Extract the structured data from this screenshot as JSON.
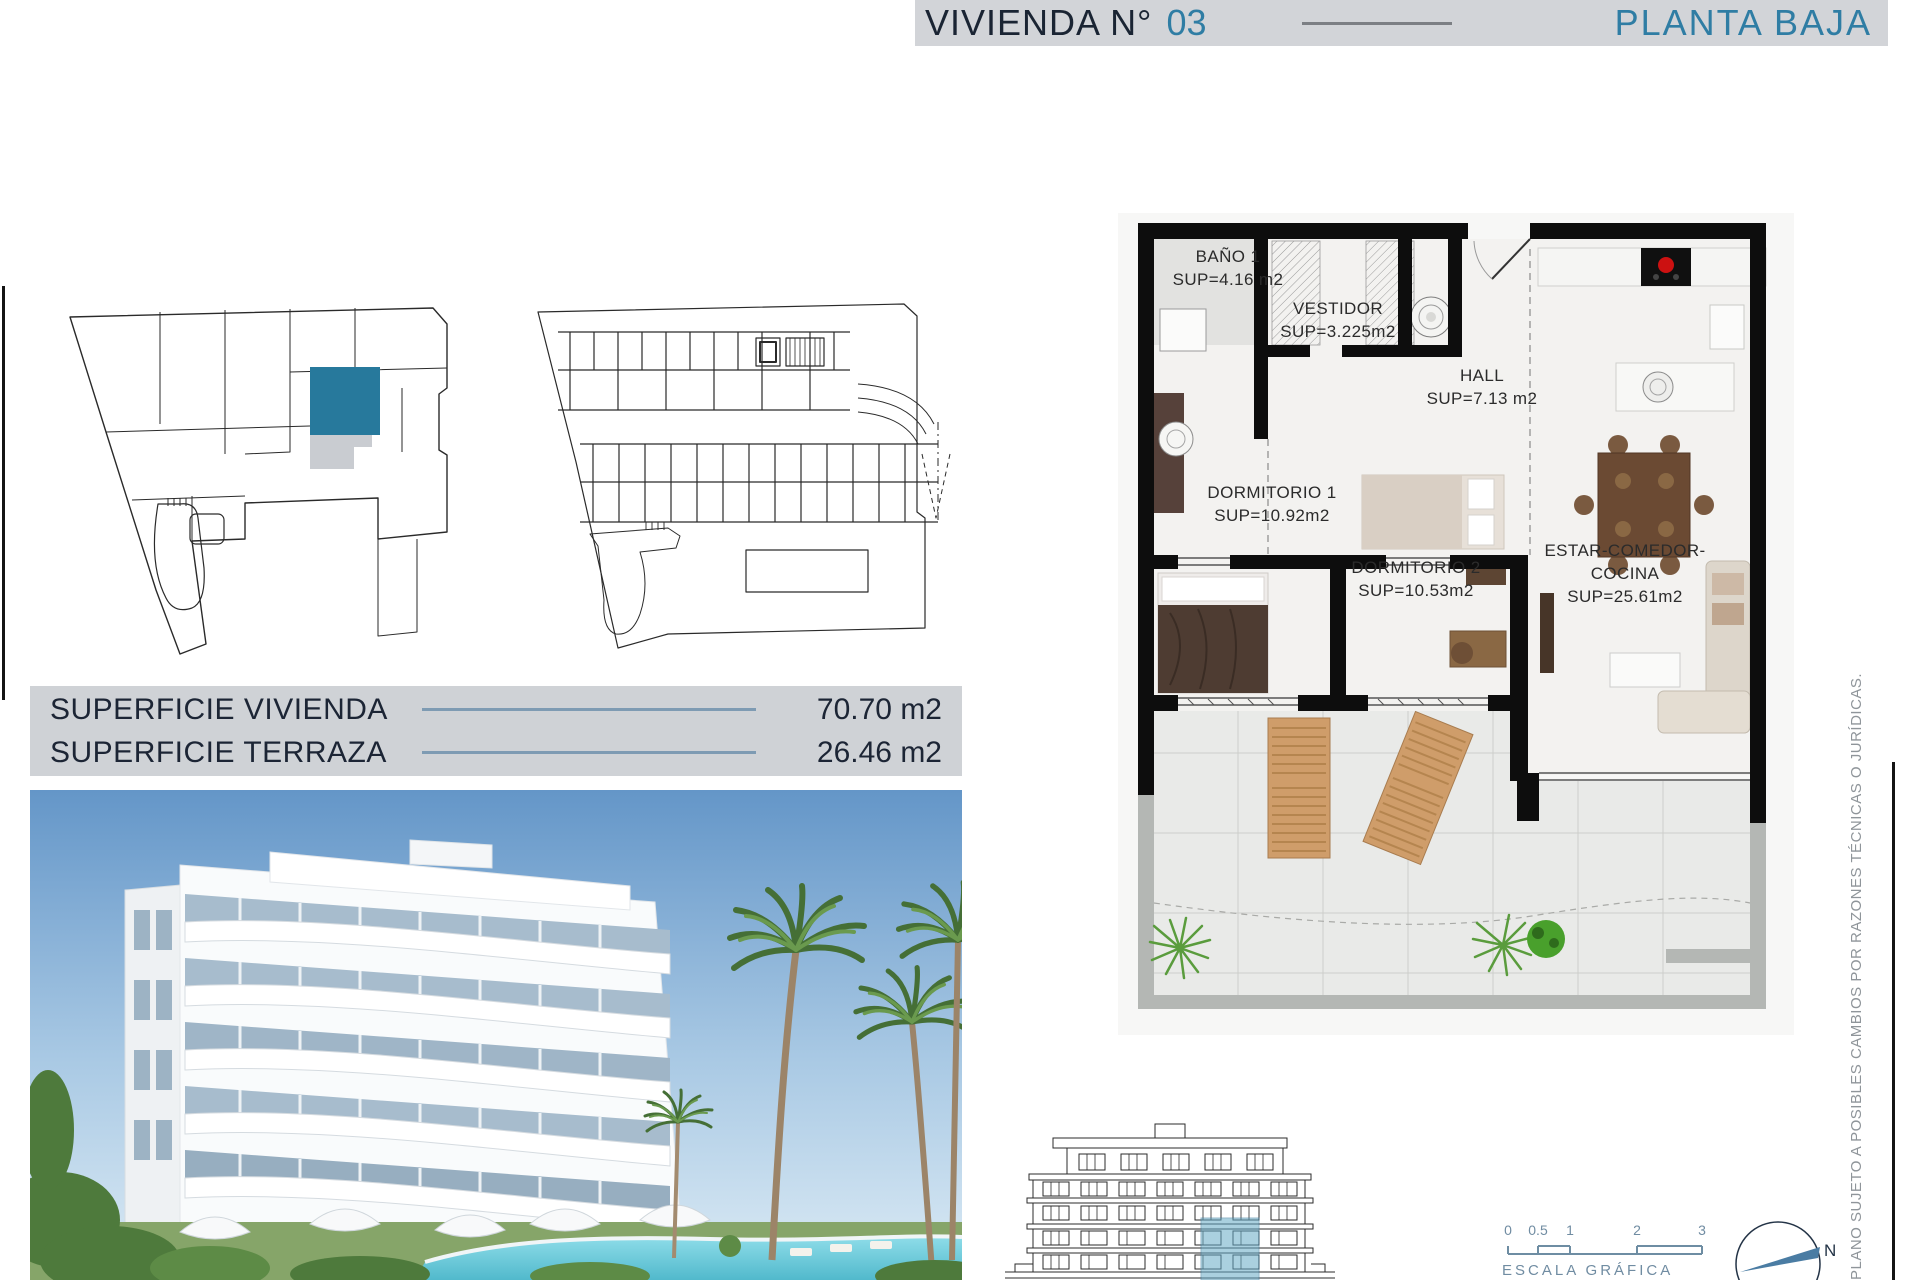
{
  "header": {
    "title_prefix": "VIVIENDA N°",
    "unit_number": "03",
    "plan_name": "PLANTA BAJA"
  },
  "surfaces": {
    "rows": [
      {
        "label": "SUPERFICIE VIVIENDA",
        "value": "70.70 m2"
      },
      {
        "label": "SUPERFICIE TERRAZA",
        "value": "26.46 m2"
      }
    ]
  },
  "floor_plan": {
    "rooms": [
      {
        "name": "BAÑO 1",
        "sup": "SUP=4.16 m2"
      },
      {
        "name": "VESTIDOR",
        "sup": "SUP=3.225m2"
      },
      {
        "name": "HALL",
        "sup": "SUP=7.13 m2"
      },
      {
        "name": "DORMITORIO 1",
        "sup": "SUP=10.92m2"
      },
      {
        "name": "DORMITORIO 2",
        "sup": "SUP=10.53m2"
      },
      {
        "name": "ESTAR-COMEDOR-COCINA",
        "sup": "SUP=25.61m2"
      }
    ]
  },
  "scale_bar": {
    "ticks": [
      "0",
      "0.5",
      "1",
      "2",
      "3"
    ],
    "label": "ESCALA GRÁFICA"
  },
  "compass": {
    "north_label": "N"
  },
  "disclaimer": "PLANO SUJETO A POSIBLES CAMBIOS POR RAZONES TÉCNICAS O JURÍDICAS.",
  "colors": {
    "accent_teal": "#2f7da4",
    "header_bg": "#d2d4d8",
    "navy_text": "#1a2433",
    "steel_blue": "#7e9bb3",
    "unit_highlight": "#27799c",
    "elevation_highlight": "#66aac6"
  }
}
